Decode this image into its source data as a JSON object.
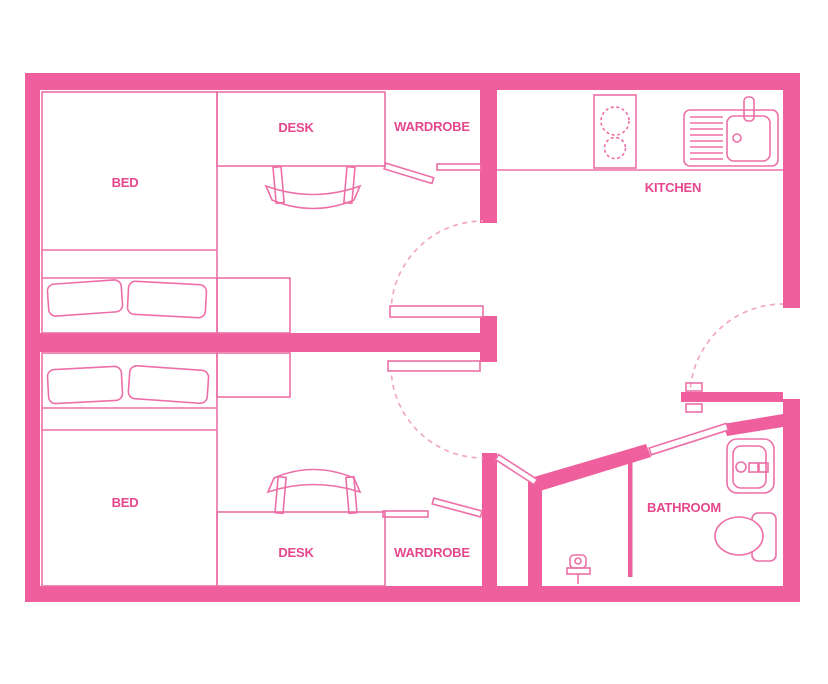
{
  "colors": {
    "wall": "#EF5F9E",
    "furniture_line": "#ED6FA7",
    "label_text": "#E5478E",
    "door_arc": "#F2A7CA",
    "background": "#FFFFFF"
  },
  "plan": {
    "title": "Twin studio floor plan",
    "bedroom_top": {
      "bed": "BED",
      "desk": "DESK",
      "wardrobe": "WARDROBE"
    },
    "bedroom_bottom": {
      "bed": "BED",
      "desk": "DESK",
      "wardrobe": "WARDROBE"
    },
    "kitchen": {
      "label": "KITCHEN"
    },
    "bathroom": {
      "label": "BATHROOM"
    },
    "icons": {
      "stove": "stove-burners-icon",
      "kitchen_sink": "kitchen-sink-icon",
      "bathroom_sink": "bathroom-sink-icon",
      "toilet": "toilet-icon",
      "shower": "shower-head-icon",
      "door_handle": "door-handle-icon"
    }
  }
}
